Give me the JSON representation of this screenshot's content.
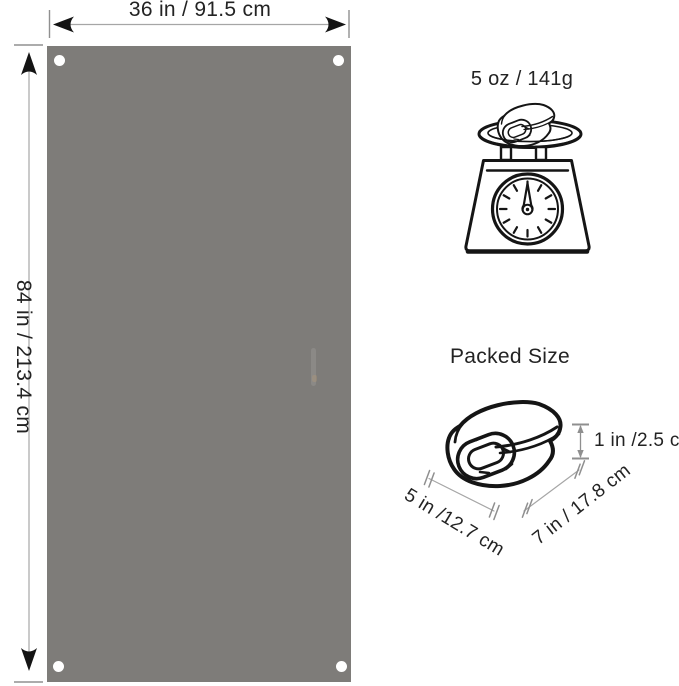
{
  "diagram": {
    "flat": {
      "width": "36 in / 91.5 cm",
      "height": "84 in / 213.4 cm",
      "panel_color": "#7e7c79",
      "grommet_count": 4
    },
    "weight": "5 oz / 141g",
    "packed": {
      "title": "Packed Size",
      "height": "1 in /2.5 cm",
      "width": "5 in /12.7 cm",
      "depth": "7 in / 17.8 cm"
    }
  },
  "icons": {
    "weight": "kitchen-scale-icon",
    "on_scale": "rolled-blanket-icon",
    "packed": "rolled-blanket-icon"
  },
  "colors": {
    "background": "#ffffff",
    "ink": "#151515",
    "dimension_line": "#a6a6a6",
    "tick": "#909090",
    "arrow": "#141414"
  }
}
